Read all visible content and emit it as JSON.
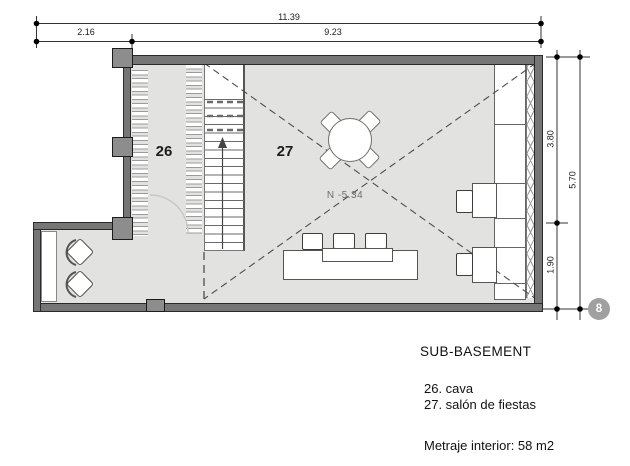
{
  "plan": {
    "room_numbers": {
      "cava": "26",
      "salon": "27"
    },
    "level_label": "N -5.34",
    "grid_marker": "8",
    "dims": {
      "total_width": "11.39",
      "left_width": "2.16",
      "right_width": "9.23",
      "upper_height": "3.80",
      "lower_height": "1.90",
      "total_height": "5.70"
    }
  },
  "title_block": {
    "title": "SUB-BASEMENT",
    "rooms": [
      {
        "label": "26. cava"
      },
      {
        "label": "27. salón de fiestas"
      }
    ],
    "area_note": "Metraje interior: 58 m2"
  },
  "colors": {
    "floor": "#e2e2e1",
    "wall": "#767676",
    "marker_fill": "#a0a0a0"
  }
}
